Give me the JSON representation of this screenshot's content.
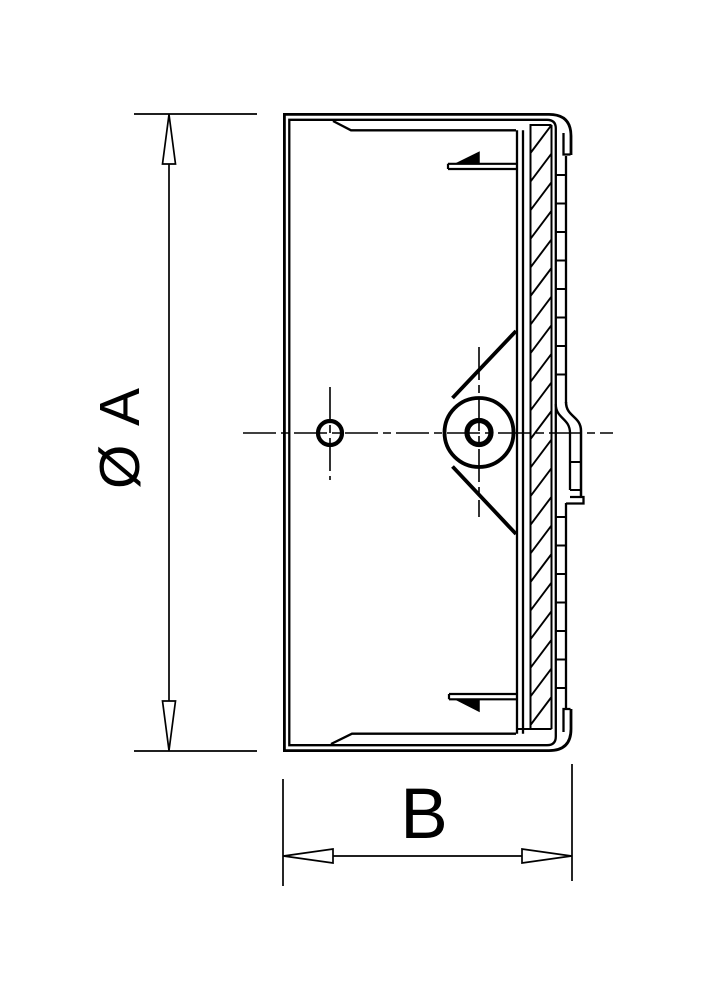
{
  "drawing": {
    "kind": "technical-section-drawing",
    "labels": {
      "diameter": "Ø A",
      "width": "B"
    },
    "colors": {
      "line": "#000000",
      "background": "#ffffff"
    }
  }
}
